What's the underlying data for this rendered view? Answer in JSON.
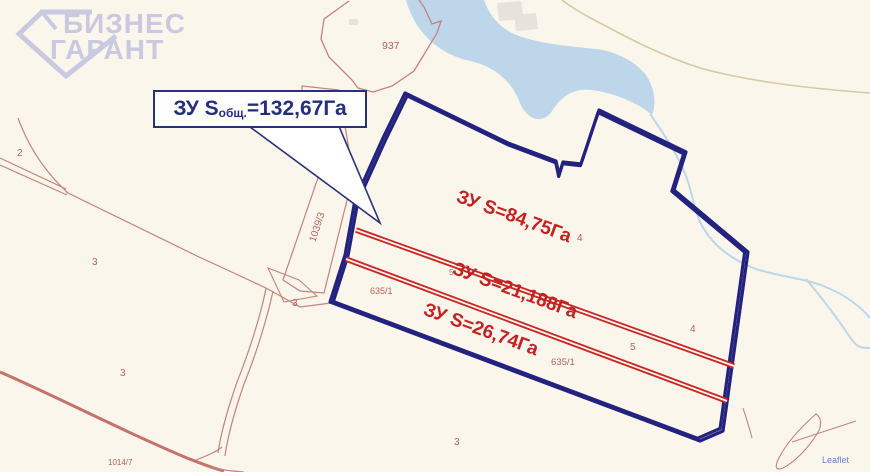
{
  "watermark": {
    "line1": "БИЗНЕС",
    "line2": "ГАРАНТ"
  },
  "callout": {
    "prefix": "ЗУ S",
    "subscript": "общ.",
    "value": "=132,67Га"
  },
  "strip_labels": [
    {
      "text": "ЗУ S=84,75Га"
    },
    {
      "text": "ЗУ S=21,188Га"
    },
    {
      "text": "ЗУ S=26,74Га"
    }
  ],
  "parcel_numbers": [
    {
      "text": "937"
    },
    {
      "text": "2"
    },
    {
      "text": "3"
    },
    {
      "text": "3"
    },
    {
      "text": "3"
    },
    {
      "text": "3"
    },
    {
      "text": "4"
    },
    {
      "text": "4"
    },
    {
      "text": "5"
    },
    {
      "text": "5"
    },
    {
      "text": "635/1"
    },
    {
      "text": "635/1"
    },
    {
      "text": "1039/3"
    },
    {
      "text": "1014/7"
    }
  ],
  "attribution": {
    "text": "Leaflet"
  },
  "colors": {
    "background": "#faf6ec",
    "water": "#bdd6e9",
    "boundary_outer_navy": "#23237f",
    "boundary_inner_red": "#cc2525",
    "cadastral_line_salmon": "#c4837b",
    "road_brown": "#c4736b",
    "road_tan": "#d6c9a4",
    "building_gray": "#e7e3da",
    "strip_label_red": "#c32222",
    "callout_navy": "#232e7d",
    "watermark_lavender": "#c9c9e0",
    "parcel_number_brown": "#b2625c",
    "attribution_blue": "#6c83b5"
  }
}
